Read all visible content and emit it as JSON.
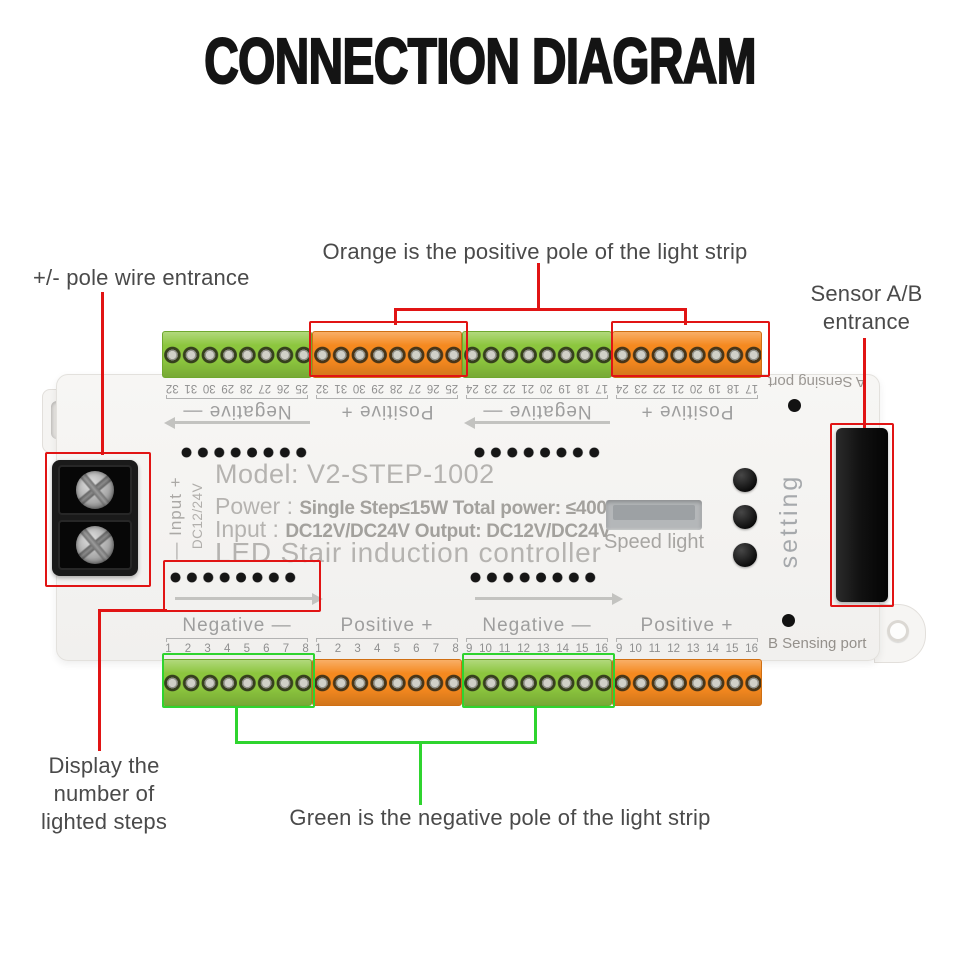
{
  "title": "CONNECTION DIAGRAM",
  "annotations": {
    "pole_wire": "+/- pole wire entrance",
    "orange_positive": "Orange is the positive pole of the light strip",
    "sensor": {
      "line1": "Sensor A/B",
      "line2": "entrance"
    },
    "display_steps": {
      "line1": "Display the",
      "line2": "number of",
      "line3": "lighted steps"
    },
    "green_negative": "Green is the negative pole of the light strip"
  },
  "board": {
    "model": "Model: V2-STEP-1002",
    "power_label": "Power :",
    "power_value": "Single Step≤15W Total power: ≤400W",
    "input_label": "Input :",
    "input_value": "DC12V/DC24V Output: DC12V/DC24V",
    "product_name": "LED Stair induction controller",
    "speed_light_label": "Speed light",
    "setting_label": "setting",
    "sensing_port_a": "A Sensing port",
    "sensing_port_b": "B Sensing port",
    "dc_input_label": "— Input +",
    "dc_voltage_label": "DC12/24V"
  },
  "terminals": {
    "top": [
      {
        "polarity": "Negative —",
        "numbers": "25 26 27 28 29 30 31 32",
        "color": "green"
      },
      {
        "polarity": "Positive +",
        "numbers": "25 26 27 28 29 30 31 32",
        "color": "orange"
      },
      {
        "polarity": "Negative —",
        "numbers": "17 18 19 20 21 22 23 24",
        "color": "green"
      },
      {
        "polarity": "Positive +",
        "numbers": "17 18 19 20 21 22 23 24",
        "color": "orange"
      }
    ],
    "bottom": [
      {
        "polarity": "Negative —",
        "numbers": "1 2 3 4 5 6 7 8",
        "color": "green"
      },
      {
        "polarity": "Positive +",
        "numbers": "1 2 3 4 5 6 7 8",
        "color": "orange"
      },
      {
        "polarity": "Negative —",
        "numbers": "9 10 11 12 13 14 15 16",
        "color": "green"
      },
      {
        "polarity": "Positive +",
        "numbers": "9 10 11 12 13 14 15 16",
        "color": "orange"
      }
    ]
  },
  "colors": {
    "callout_red": "#e11414",
    "callout_green": "#2fd42f",
    "terminal_green": "#8cc63e",
    "terminal_orange": "#f5891f"
  }
}
